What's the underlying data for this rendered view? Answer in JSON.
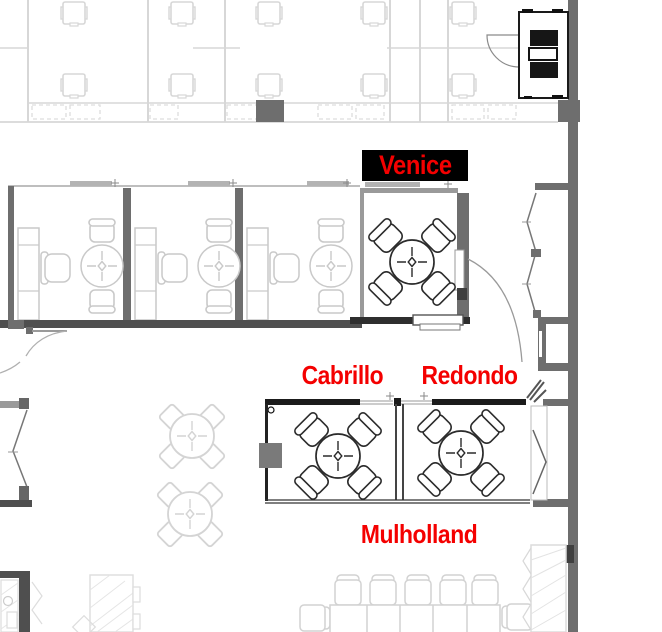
{
  "rooms": {
    "venice": {
      "label": "Venice",
      "highlighted": true
    },
    "cabrillo": {
      "label": "Cabrillo",
      "highlighted": false
    },
    "redondo": {
      "label": "Redondo",
      "highlighted": false
    },
    "mulholland": {
      "label": "Mulholland",
      "highlighted": false
    }
  },
  "colors": {
    "label-red": "#f40000",
    "highlight-bg": "#000000",
    "wall-dark": "#6e6e6e",
    "wall-black": "#1b1b1b",
    "line-light": "#d6d6d6",
    "line-mid": "#c9c9c9"
  }
}
